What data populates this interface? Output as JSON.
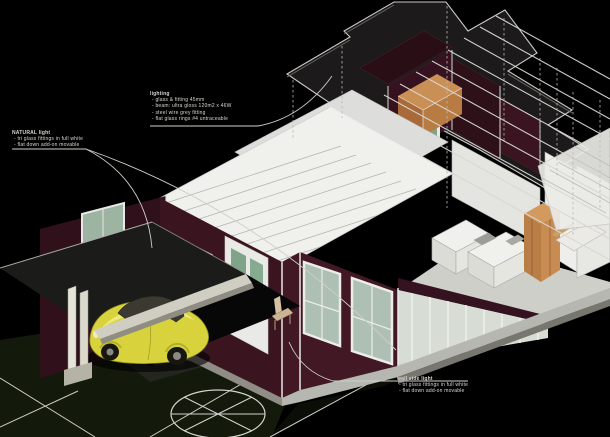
{
  "scene": {
    "type": "architectural 3D cutaway axonometric rendering",
    "description": "Single-storey house cutaway with detached roof-plan slab floating above, exposed interior rooms, carport with yellow Beetle car, tree symbol and lighting annotations on black background"
  },
  "annotations": {
    "roof_note": {
      "title": "lighting",
      "lines": [
        "- glass & fitting 45mm",
        "- beam: ultra gloss 120m2 x 46W",
        "- steel wire grey fitting",
        "- flat glass rings #4 untraceable"
      ]
    },
    "left_note": {
      "title": "NATURAL light",
      "lines": [
        "- tri glass fittings in full white",
        "- flat down add-on movable"
      ]
    },
    "wall_note": {
      "title": "wall side light",
      "lines": [
        "- tri glass fittings in full white",
        "- flat down add-on movable"
      ]
    }
  },
  "colors": {
    "background": "#000000",
    "roof_plan_slab": "#1c1a1a",
    "slab_outline": "#c9c9c5",
    "house_roof_white": "#f0f0ed",
    "wall_maroon": "#3a1520",
    "window_glass_green": "#9db4a2",
    "wood_furniture": "#c98f55",
    "car_yellow": "#d8d33c",
    "lawn_green": "#131a0b",
    "concrete_fascia": "#d0cdc3",
    "floor_slab_gray": "#b7b7b1"
  },
  "objects": {
    "car": "yellow VW Beetle in carport",
    "tree": "plan tree symbol",
    "roof_plan": "detached dark roof slab with hanger lines"
  }
}
